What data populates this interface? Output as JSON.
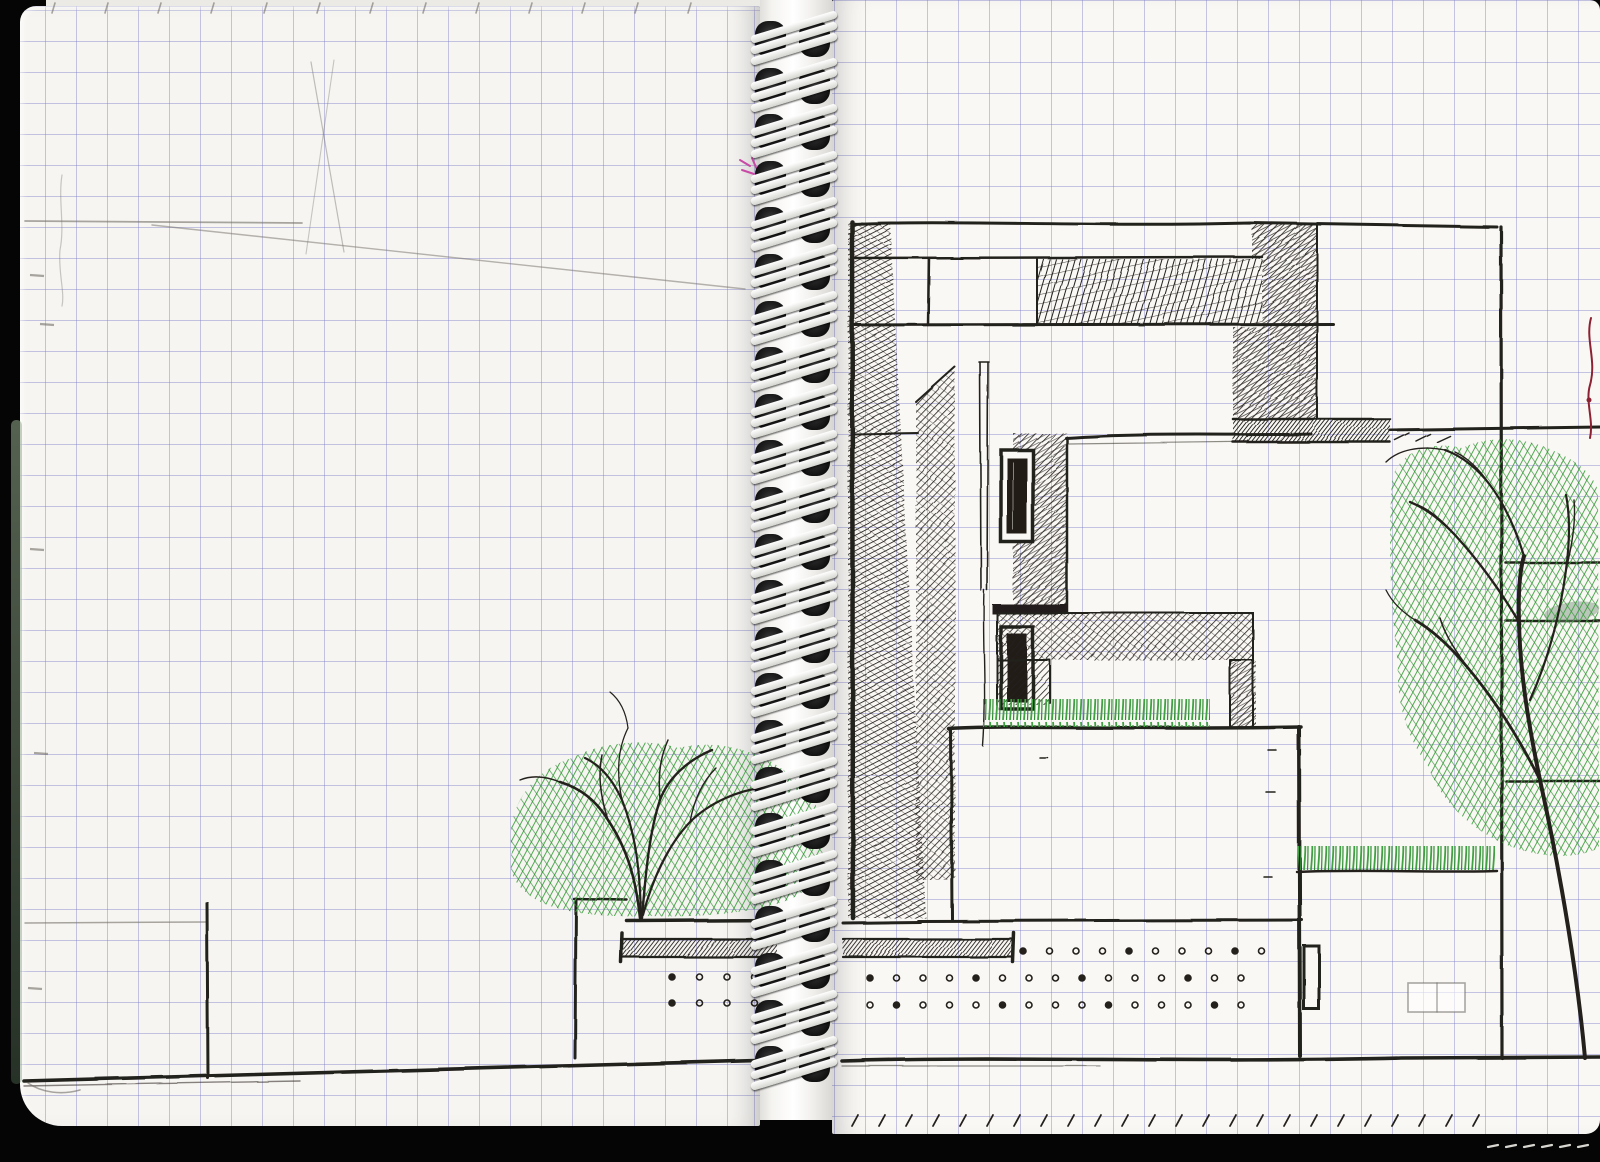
{
  "document": {
    "type": "spiral-notebook-scan",
    "description": "Scanned spread of a spiral-bound squared-paper sketchbook with a hand-drawn architectural building section in black ink, green marker trees and grass, and faint pencil guide lines. No text is present.",
    "media": "ink, green marker and pencil on graph paper"
  },
  "colors": {
    "paperLeft": "#f6f5f1",
    "paperRight": "#faf8f4",
    "grid": "rgba(122,122,198,.42)",
    "ink": "#24201c",
    "pencil": "rgba(115,110,104,.6)",
    "green": "#3da23f",
    "greenDark": "#2e8c33",
    "red": "#8c2133",
    "pink": "#c84aa6",
    "lightEdge": "#d8d6d0",
    "black": "#050505",
    "coilWhite": "#f2f2ef"
  },
  "grid": {
    "cell_px": 31
  },
  "spiral": {
    "count": 23,
    "top": 18,
    "spacing": 46.6,
    "left": 752
  },
  "dot_grids": [
    {
      "name": "left-terrace-dots",
      "x0": 672,
      "dx": 27.5,
      "cols": 4,
      "y0": 977,
      "dy": 26,
      "rows": 2
    },
    {
      "name": "right-dots-row1",
      "x0": 1023,
      "dx": 26.5,
      "cols": 10,
      "y0": 951,
      "dy": 26,
      "rows": 1
    },
    {
      "name": "right-dots-rows23",
      "x0": 870,
      "dx": 26.5,
      "cols": 15,
      "y0": 978,
      "dy": 27,
      "rows": 2
    }
  ],
  "tick_rows": [
    {
      "name": "bottom-edge-ticks",
      "x0": 852,
      "dx": 27,
      "count": 24,
      "y": 1126,
      "tx": 6,
      "ty": -11,
      "color": "ink",
      "width": 1.8
    },
    {
      "name": "top-edge-ticks",
      "x0": 52,
      "dx": 53,
      "count": 13,
      "y": 13,
      "tx": 3,
      "ty": -10,
      "color": "pencil",
      "width": 1.6
    },
    {
      "name": "under-page-dashes",
      "x0": 1488,
      "dx": 18,
      "count": 6,
      "y": 1147,
      "tx": 10,
      "ty": -2,
      "color": "lightEdge",
      "width": 2.2
    }
  ],
  "margin_ticks": [
    [
      30,
      275
    ],
    [
      40,
      324
    ],
    [
      30,
      549
    ],
    [
      34,
      753
    ],
    [
      28,
      988
    ]
  ],
  "elements": [
    "roofline",
    "shadowed-tower",
    "clerestory-band",
    "scribble-panel",
    "corner-shadow-wedge",
    "balcony-ledge",
    "right-facade-edge",
    "pylon",
    "mast-fin",
    "upper-window",
    "lower-window",
    "upper-white-volume",
    "mid-shadow-band",
    "roof-grass-strip",
    "lower-white-volume",
    "terrace-slab",
    "under-terrace-beams",
    "column-dot-grid",
    "entry-door",
    "pencil-rectangle",
    "right-lawn-strip",
    "side-floor-lines",
    "left-tree",
    "right-tree",
    "planter-wall",
    "flag-pole",
    "ground-line",
    "pencil-guide-lines",
    "red-pen-mark",
    "pink-pen-mark"
  ]
}
